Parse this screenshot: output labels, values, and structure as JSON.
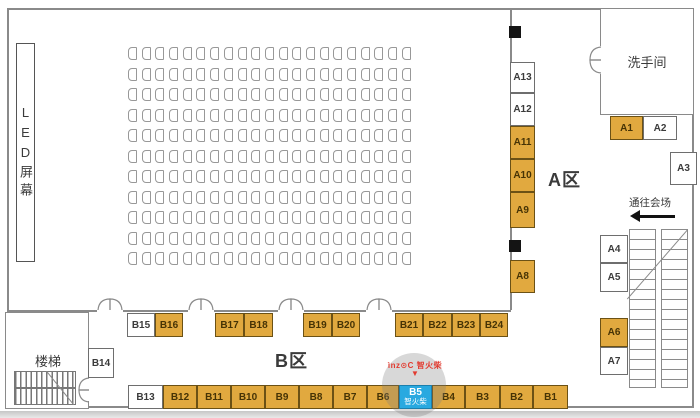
{
  "labels": {
    "led_screen": "LED屏幕",
    "restroom": "洗手间",
    "stair_room": "楼梯",
    "area_a": "A区",
    "area_b": "B区",
    "to_venue": "通往会场"
  },
  "brand": {
    "logo_text": "ìnz⊙C 智火柴",
    "marker": "▼",
    "featured_booth": "B5",
    "featured_name": "智火柴"
  },
  "seating": {
    "rows": 11,
    "cols": 21
  },
  "colors": {
    "sold": "#E1A93F",
    "available": "#FFFFFF",
    "featured": "#29A9E0",
    "brand_red": "#E23B30",
    "wall_gray": "#8A8A8A"
  },
  "booths": [
    {
      "id": "A13",
      "status": "available"
    },
    {
      "id": "A12",
      "status": "available"
    },
    {
      "id": "A11",
      "status": "sold"
    },
    {
      "id": "A10",
      "status": "sold"
    },
    {
      "id": "A9",
      "status": "sold"
    },
    {
      "id": "A8",
      "status": "sold"
    },
    {
      "id": "A1",
      "status": "sold"
    },
    {
      "id": "A2",
      "status": "available"
    },
    {
      "id": "A3",
      "status": "available"
    },
    {
      "id": "A4",
      "status": "available"
    },
    {
      "id": "A5",
      "status": "available"
    },
    {
      "id": "A6",
      "status": "sold"
    },
    {
      "id": "A7",
      "status": "available"
    },
    {
      "id": "B15",
      "status": "available"
    },
    {
      "id": "B16",
      "status": "sold"
    },
    {
      "id": "B17",
      "status": "sold"
    },
    {
      "id": "B18",
      "status": "sold"
    },
    {
      "id": "B19",
      "status": "sold"
    },
    {
      "id": "B20",
      "status": "sold"
    },
    {
      "id": "B21",
      "status": "sold"
    },
    {
      "id": "B22",
      "status": "sold"
    },
    {
      "id": "B23",
      "status": "sold"
    },
    {
      "id": "B24",
      "status": "sold"
    },
    {
      "id": "B14",
      "status": "available"
    },
    {
      "id": "B13",
      "status": "available"
    },
    {
      "id": "B12",
      "status": "sold"
    },
    {
      "id": "B11",
      "status": "sold"
    },
    {
      "id": "B10",
      "status": "sold"
    },
    {
      "id": "B9",
      "status": "sold"
    },
    {
      "id": "B8",
      "status": "sold"
    },
    {
      "id": "B7",
      "status": "sold"
    },
    {
      "id": "B6",
      "status": "sold"
    },
    {
      "id": "B5",
      "status": "featured"
    },
    {
      "id": "B4",
      "status": "sold"
    },
    {
      "id": "B3",
      "status": "sold"
    },
    {
      "id": "B2",
      "status": "sold"
    },
    {
      "id": "B1",
      "status": "sold"
    }
  ]
}
